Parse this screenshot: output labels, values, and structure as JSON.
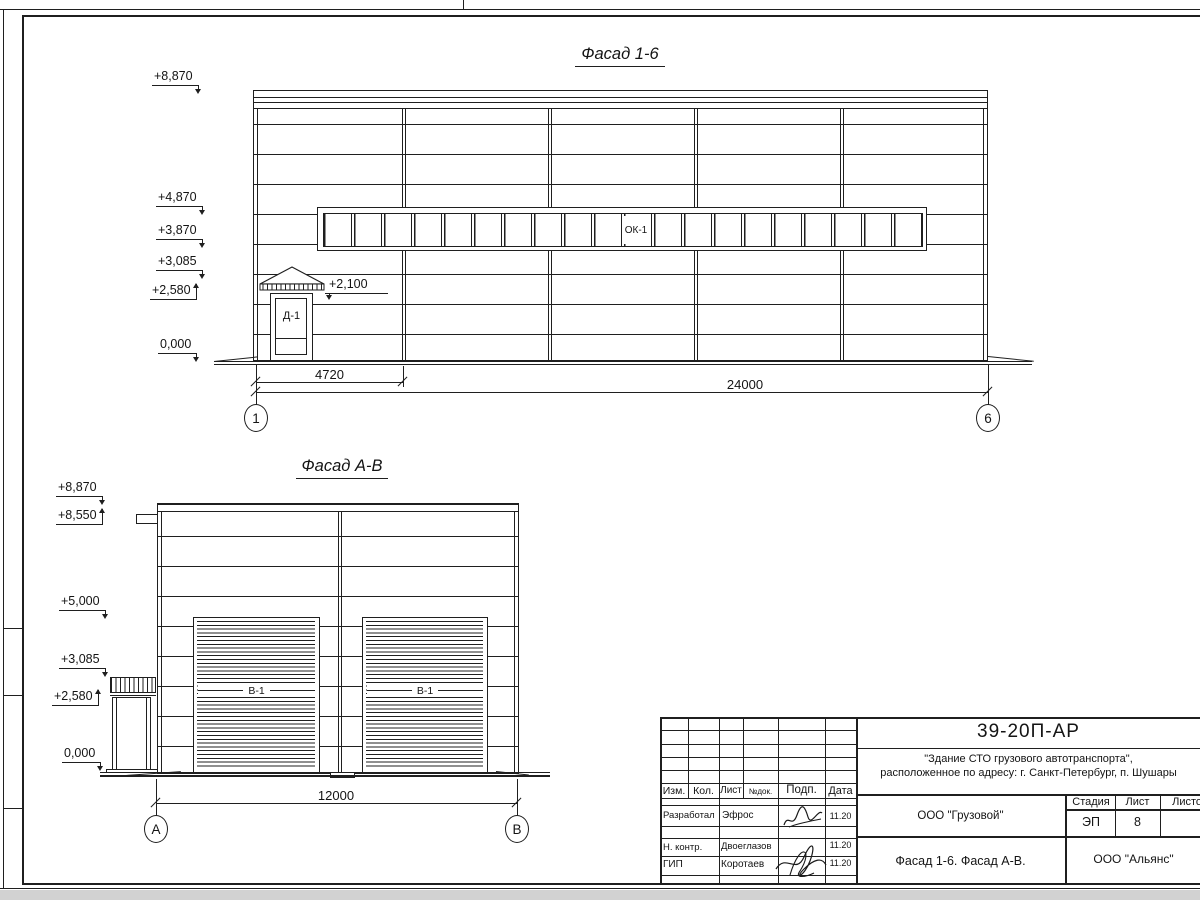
{
  "colors": {
    "line": "#1f1f1f",
    "paper": "#ffffff",
    "margin_gray": "#d2d2d2"
  },
  "facade16": {
    "title": "Фасад 1-6",
    "window_band_label": "ОК-1",
    "door_label": "Д-1",
    "elev_8870": "+8,870",
    "elev_4870": "+4,870",
    "elev_3870": "+3,870",
    "elev_3085": "+3,085",
    "elev_2580": "+2,580",
    "elev_2100": "+2,100",
    "elev_0": "0,000",
    "dim_first_bay": "4720",
    "dim_total": "24000",
    "axis_left": "1",
    "axis_right": "6"
  },
  "facadeAB": {
    "title": "Фасад А-В",
    "gate_label": "В-1",
    "elev_8870": "+8,870",
    "elev_8550": "+8,550",
    "elev_5000": "+5,000",
    "elev_3085": "+3,085",
    "elev_2580": "+2,580",
    "elev_0": "0,000",
    "dim_total": "12000",
    "axis_left": "А",
    "axis_right": "В"
  },
  "titleblock": {
    "doc_number": "39-20П-АР",
    "project_line1": "\"Здание СТО грузового автотранспорта\",",
    "project_line2": "расположенное по адресу: г. Санкт-Петербург, п. Шушары",
    "col_izm": "Изм.",
    "col_kol": "Кол.",
    "col_list": "Лист",
    "col_ndok": "№док.",
    "col_podp": "Подп.",
    "col_data": "Дата",
    "row1_role": "Разработал",
    "row1_name": "Эфрос",
    "row1_date": "11.20",
    "row2_role": "Н. контр.",
    "row2_name": "Двоеглазов",
    "row2_date": "11.20",
    "row3_role": "ГИП",
    "row3_name": "Коротаев",
    "row3_date": "11.20",
    "customer": "ООО \"Грузовой\"",
    "sheet_title": "Фасад 1-6. Фасад А-В.",
    "contractor": "ООО \"Альянс\"",
    "stage_header": "Стадия",
    "sheet_header": "Лист",
    "sheets_header": "Листов",
    "stage_value": "ЭП",
    "sheet_value": "8"
  }
}
